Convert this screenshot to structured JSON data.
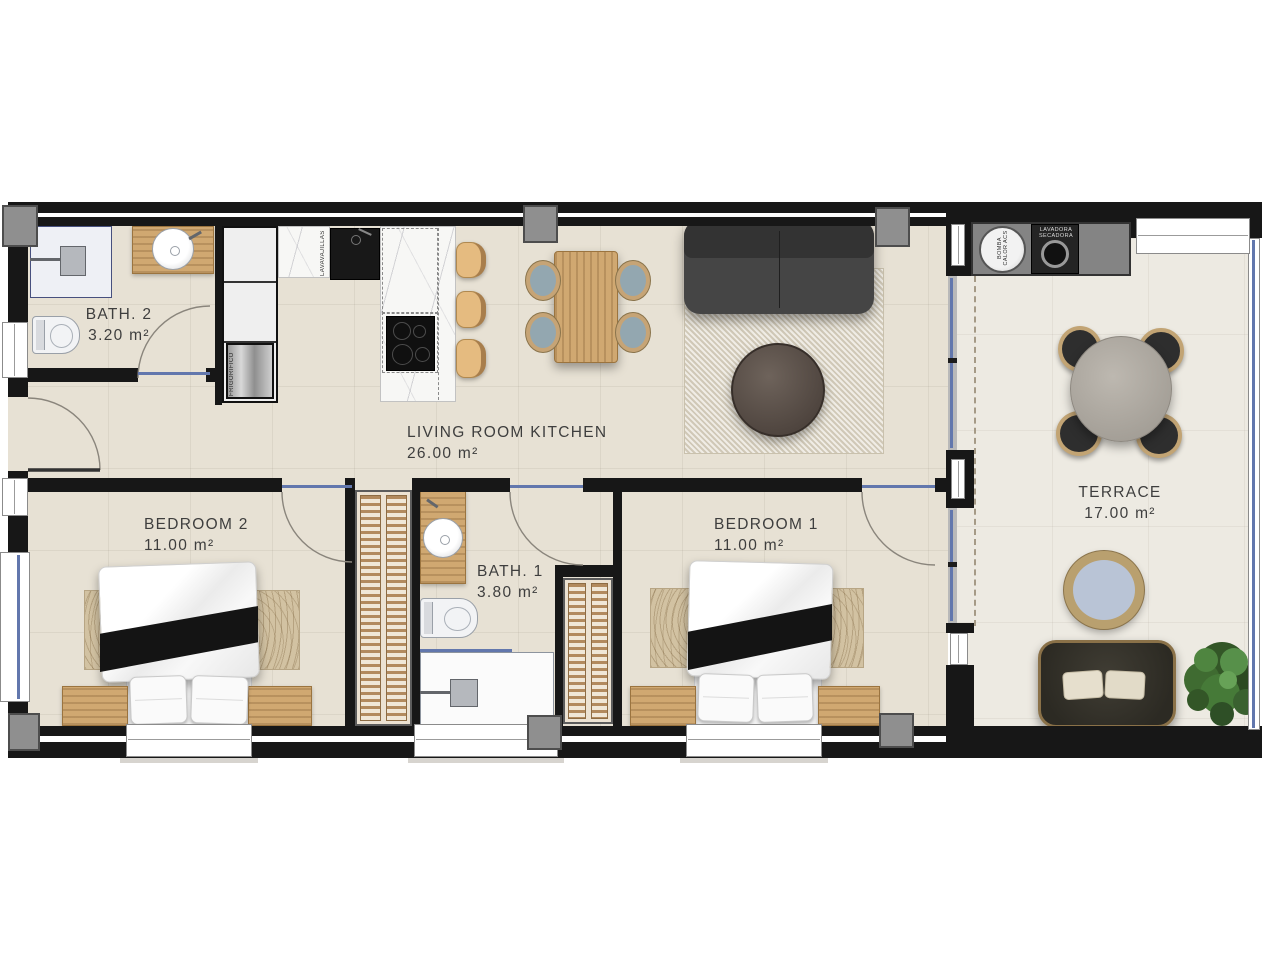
{
  "rooms": {
    "bath2": {
      "name": "BATH. 2",
      "area": "3.20 m²"
    },
    "living": {
      "name": "LIVING ROOM KITCHEN",
      "area": "26.00 m²"
    },
    "bedroom2": {
      "name": "BEDROOM 2",
      "area": "11.00 m²"
    },
    "bath1": {
      "name": "BATH. 1",
      "area": "3.80 m²"
    },
    "bedroom1": {
      "name": "BEDROOM 1",
      "area": "11.00 m²"
    },
    "terrace": {
      "name": "TERRACE",
      "area": "17.00 m²"
    }
  },
  "appliances": {
    "dishwasher": {
      "label": "LAVAVAJILLAS"
    },
    "fridge": {
      "label": "FRIGORIFICO"
    },
    "heat_pump": {
      "label": "BOMBA CALOR ACS"
    },
    "washer_dryer": {
      "label": "LAVADORA SECADORA"
    }
  },
  "colors": {
    "wall": "#171717",
    "floor": "#e7e1d4",
    "terrace_floor": "#edeae2",
    "glass": "#6277ad",
    "wood_light": "#d0a871",
    "pillar": "#8f8f8f",
    "marble": "#f7f7f5",
    "sofa": "#454545",
    "rug": "#ddd6c6",
    "bed_rug": "#d2c2a2",
    "throw": "#141414",
    "text": "#3e3e3e"
  }
}
